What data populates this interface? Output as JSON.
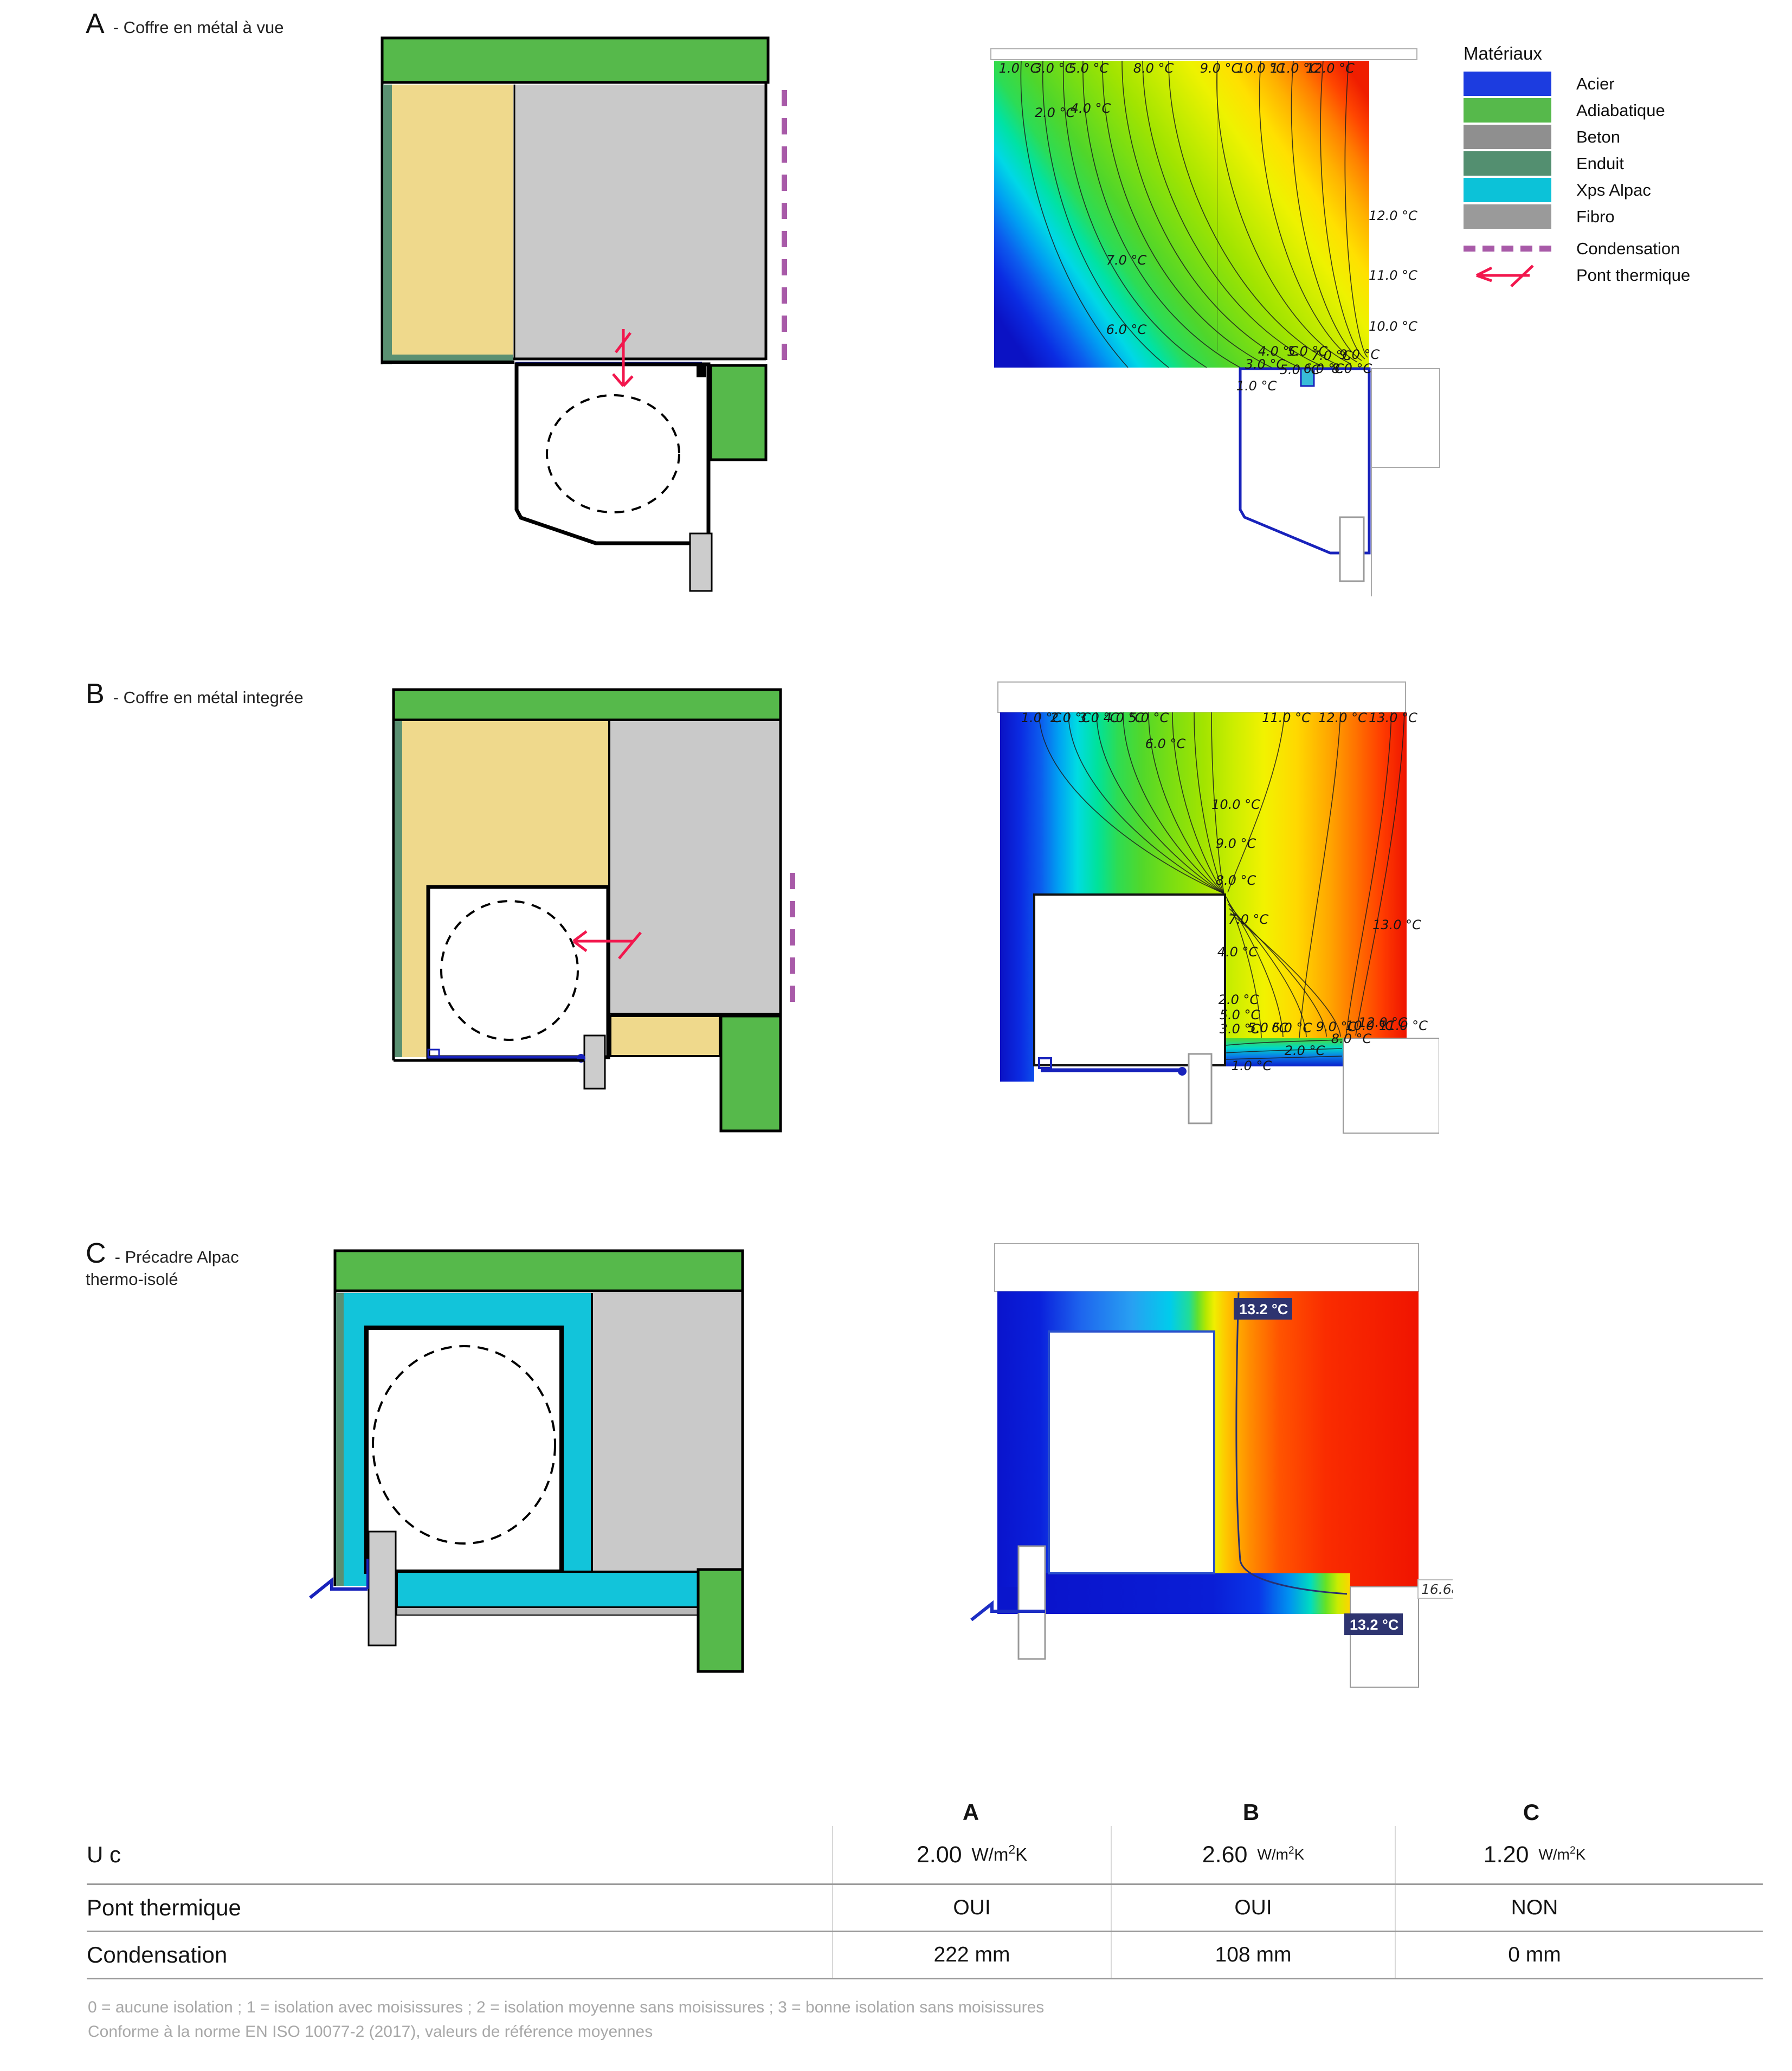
{
  "sections": [
    {
      "letter": "A",
      "title": "- Coffre en métal à vue"
    },
    {
      "letter": "B",
      "title": "- Coffre en métal integrée"
    },
    {
      "letter": "C",
      "title": "- Précadre Alpac",
      "title_line2": "thermo-isolé"
    }
  ],
  "legend": {
    "title": "Matériaux",
    "materials": [
      {
        "label": "Acier",
        "color": "#1c3ce0"
      },
      {
        "label": "Adiabatique",
        "color": "#56b94b"
      },
      {
        "label": "Beton",
        "color": "#8f8f8f"
      },
      {
        "label": "Enduit",
        "color": "#538f70"
      },
      {
        "label": "Xps Alpac",
        "color": "#0cc2d8"
      },
      {
        "label": "Fibro",
        "color": "#9a9a9a"
      }
    ],
    "condensation": {
      "label": "Condensation",
      "color": "#a85aa8"
    },
    "pont_thermique": {
      "label": "Pont thermique",
      "color": "#f2174d"
    }
  },
  "thermal_a": {
    "top_labels": [
      "1.0 °C",
      "3.0 °C",
      "5.0 °C",
      "8.0 °C",
      "9.0 °C",
      "10.0 °C",
      "11.0 °C",
      "12.0 °C"
    ],
    "upper_labels": [
      "2.0 °C",
      "4.0 °C"
    ],
    "inner_labels": [
      "7.0 °C",
      "6.0 °C"
    ],
    "right_labels": [
      "12.0 °C",
      "11.0 °C",
      "10.0 °C"
    ],
    "bottom_labels": [
      "4.0 °C",
      "5.0 °C",
      "7.0 °C",
      "9.0 °C",
      "3.0 °C",
      "5.0 °C",
      "6.0 °C",
      "8.0 °C",
      "1.0 °C"
    ]
  },
  "thermal_b": {
    "top_labels": [
      "1.0 °C",
      "2.0 °C",
      "3.0 °C",
      "4.0 °C",
      "5.0 °C",
      "11.0 °C",
      "12.0 °C",
      "13.0 °C"
    ],
    "upper_labels": [
      "6.0 °C"
    ],
    "mid_labels": [
      "10.0 °C",
      "9.0 °C",
      "8.0 °C",
      "7.0 °C",
      "4.0 °C",
      "2.0 °C",
      "5.0 °C"
    ],
    "right_labels": [
      "13.0 °C",
      "12.0 °C"
    ],
    "bottom_labels": [
      "3.0 °C",
      "5.0 °C",
      "6.0 °C",
      "9.0 °C",
      "10.0 °C",
      "11.0 °C",
      "8.0 °C",
      "2.0 °C",
      "1.0 °C"
    ]
  },
  "thermal_c": {
    "label_top": "13.2 °C",
    "label_bottom": "13.2 °C",
    "label_right": "16.68"
  },
  "table": {
    "col_headers": [
      "A",
      "B",
      "C"
    ],
    "u_row": {
      "label": "U c",
      "values": [
        {
          "num": "2.00",
          "unit_base": "W/m",
          "unit_exp": "2",
          "unit_end": "K"
        },
        {
          "num": "2.60",
          "unit_base": "W/m",
          "unit_exp": "2",
          "unit_end": "K"
        },
        {
          "num": "1.20",
          "unit_base": "W/m",
          "unit_exp": "2",
          "unit_end": "K"
        }
      ]
    },
    "rows": [
      {
        "label": "Pont thermique",
        "values": [
          "OUI",
          "OUI",
          "NON"
        ]
      },
      {
        "label": "Condensation",
        "values": [
          "222 mm",
          "108 mm",
          "0 mm"
        ]
      }
    ]
  },
  "footnotes": [
    "0 = aucune isolation ; 1 = isolation avec moisissures ; 2 = isolation moyenne sans moisissures ; 3 = bonne isolation sans moisissures",
    "Conforme à la norme EN ISO 10077-2 (2017), valeurs de référence moyennes"
  ]
}
